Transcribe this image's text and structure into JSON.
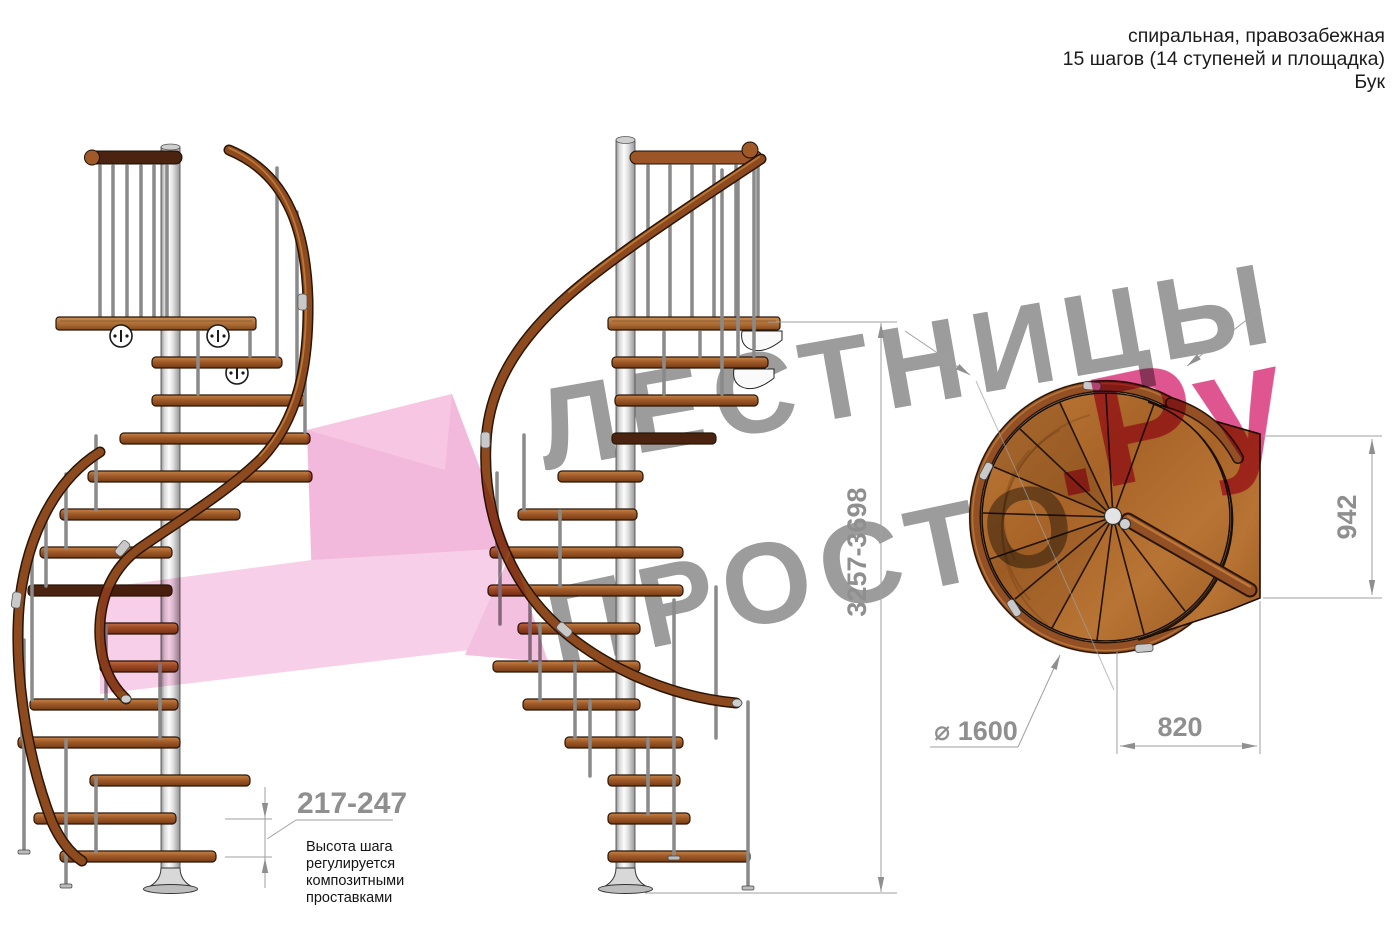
{
  "header": {
    "lines": [
      "спиральная, правозабежная",
      "15 шагов (14 ступеней и площадка)",
      "Бук"
    ]
  },
  "watermark": {
    "word_top": "ЛЕСТНИЦЫ",
    "word_bottom": "ПРОСТО",
    "word_accent": ".Ру",
    "gray_color": "#9c9c9c",
    "accent_color": "#df5590",
    "arrow_color": "#f3b9dc"
  },
  "dimensions": {
    "total_height": "3257-3698",
    "landing_width": "942",
    "landing_depth": "820",
    "diameter": "⌀ 1600",
    "step_height": "217-247",
    "step_height_note": [
      "Высота шага",
      "регулируется",
      "композитными",
      "проставками"
    ]
  },
  "colors": {
    "wood": "#9c5526",
    "wood_dark": "#6f3a14",
    "rail": "#8d4a1e",
    "dark_rail": "#4a2410",
    "pole": "#e8e8e8",
    "dimension_text": "#8f8f8f"
  }
}
